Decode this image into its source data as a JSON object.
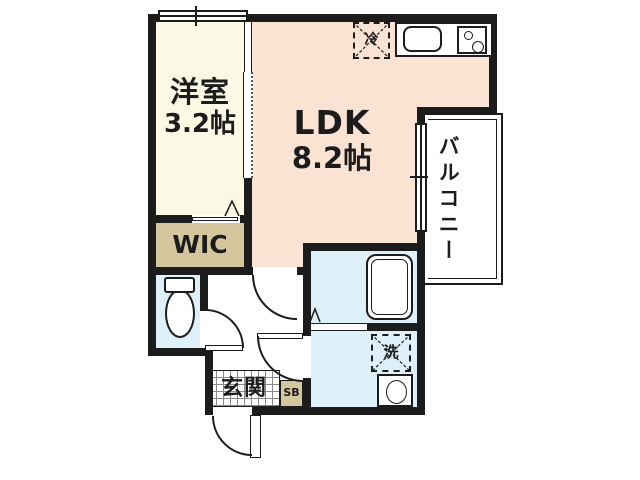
{
  "plan": {
    "rooms": {
      "western_room": {
        "name": "洋室",
        "size": "3.2帖"
      },
      "ldk": {
        "name": "LDK",
        "size": "8.2帖"
      },
      "wic": {
        "name": "WIC"
      },
      "balcony": {
        "name": "バルコニー"
      },
      "entrance": {
        "name": "玄関"
      },
      "shoe_box": {
        "name": "SB"
      }
    },
    "fixtures": {
      "refrigerator": {
        "label": "冷"
      },
      "washing_machine": {
        "label": "洗"
      },
      "bathtub_icon": "bathtub",
      "toilet_icon": "toilet",
      "kitchen_sink_icon": "kitchen-sink",
      "stove_icon": "two-burner-stove",
      "wash_basin_icon": "wash-basin"
    },
    "colors": {
      "wall": "#1c1c1c",
      "western_room_fill": "#fbf8e3",
      "ldk_fill": "#fae3d3",
      "wic_fill": "#d4c79e",
      "wet_area_fill": "#def0f9",
      "white": "#ffffff"
    }
  }
}
